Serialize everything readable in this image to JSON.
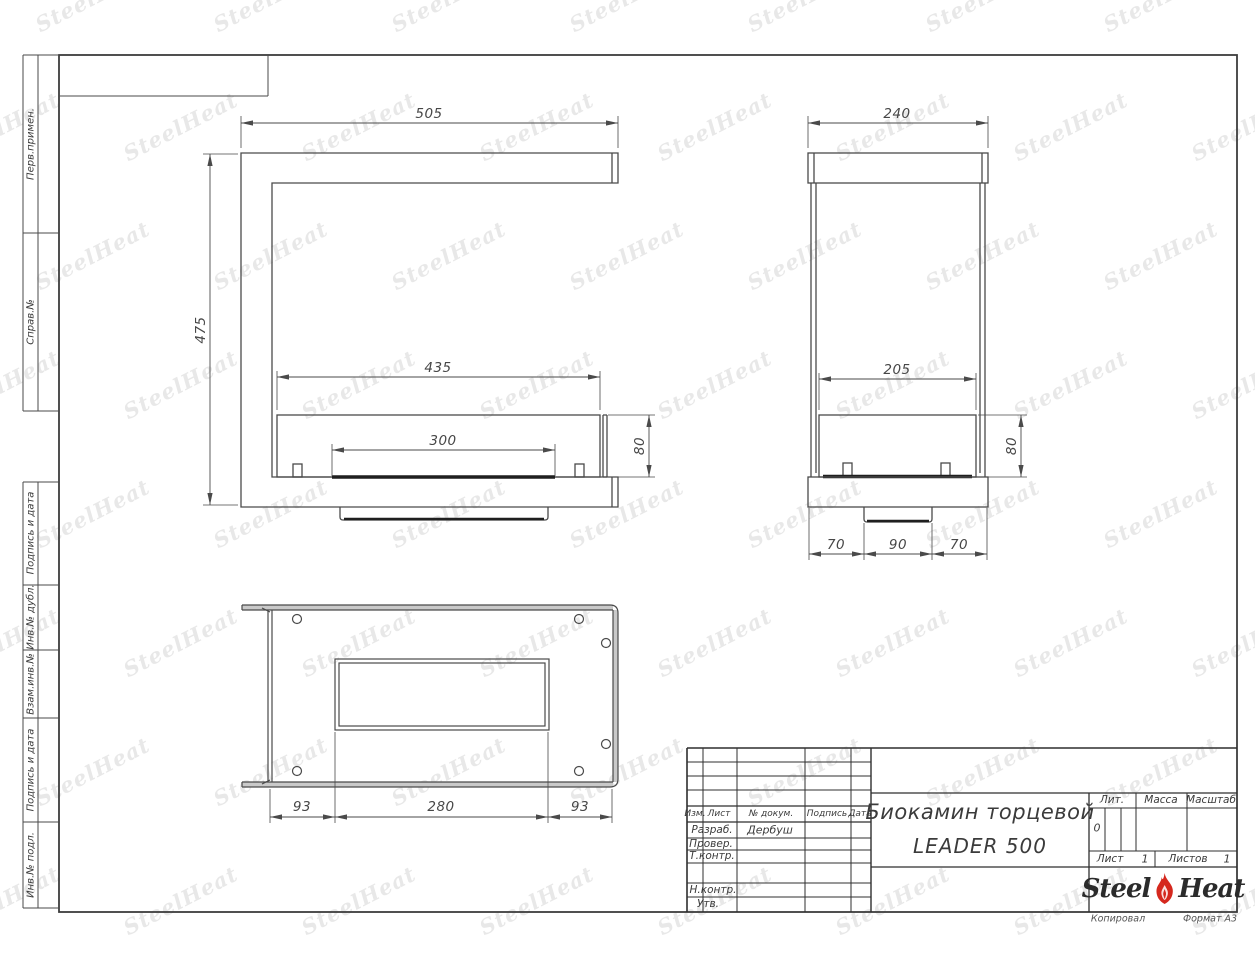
{
  "watermark": {
    "text": "SteelHeat"
  },
  "margin_labels": [
    "Перв.примен.",
    "Справ.№",
    "Подпись и дата",
    "Инв.№ дубл.",
    "Взам.инв.№",
    "Подпись и дата",
    "Инв.№ подл."
  ],
  "dims": {
    "front": {
      "width": "505",
      "height": "475",
      "opening": "435",
      "burner": "300",
      "box_height": "80"
    },
    "side": {
      "width": "240",
      "opening": "205",
      "box_height": "80",
      "seg_left": "70",
      "seg_center": "90",
      "seg_right": "70"
    },
    "top": {
      "seg_left": "93",
      "seg_center": "280",
      "seg_right": "93"
    }
  },
  "title_block": {
    "header_cols": [
      "Изм.",
      "Лист",
      "№ докум.",
      "Подпись",
      "Дата"
    ],
    "rows": [
      {
        "label": "Разраб.",
        "value": "Дербуш"
      },
      {
        "label": "Провер.",
        "value": ""
      },
      {
        "label": "Т.контр.",
        "value": ""
      },
      {
        "label": "Н.контр.",
        "value": ""
      },
      {
        "label": "Утв.",
        "value": ""
      }
    ],
    "title_line1": "Биокамин торцевой",
    "title_line2": "LEADER 500",
    "lit_label": "Лит.",
    "lit_value": "0",
    "massa_label": "Масса",
    "masshtab_label": "Масштаб",
    "sheet_label": "Лист",
    "sheet_value": "1",
    "sheets_label": "Листов",
    "sheets_value": "1",
    "logo": {
      "part1": "Steel",
      "part2": "Heat",
      "flame_color": "#d5281e"
    },
    "footer_left": "Копировал",
    "footer_right": "Формат А3"
  }
}
